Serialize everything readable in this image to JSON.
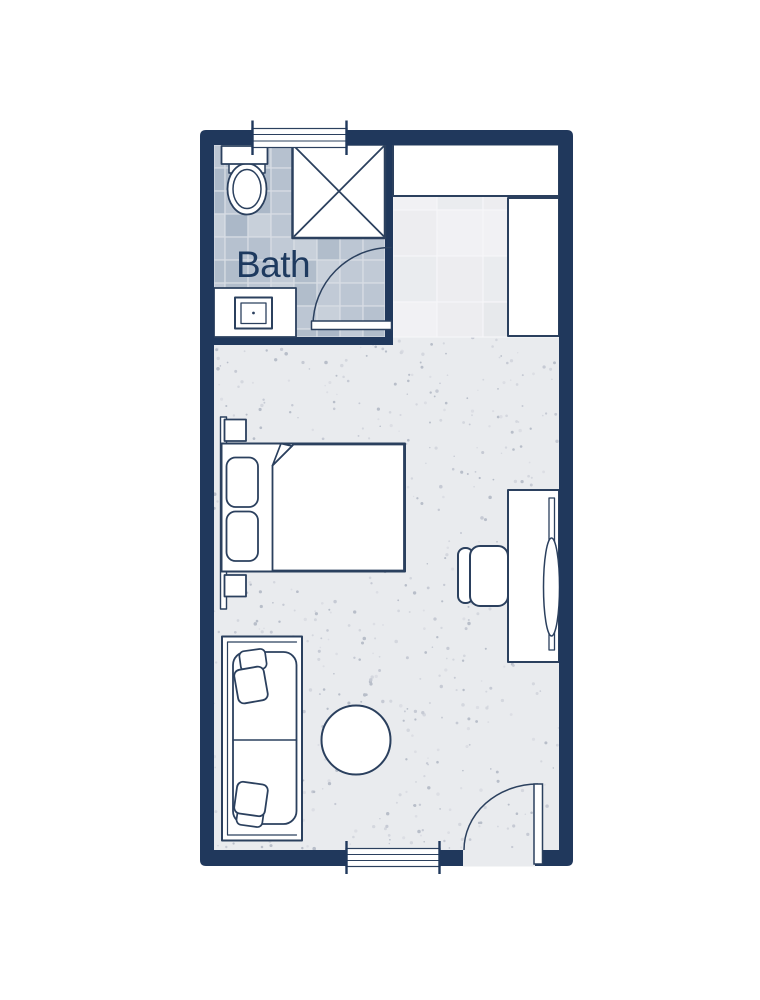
{
  "labels": {
    "bath": "Bath"
  },
  "colors": {
    "wall": "#20385c",
    "line": "#2b405e",
    "text": "#1e3a5f",
    "carpet": "#e9ebee",
    "page": "#ffffff"
  },
  "furniture_icons": [
    "bed",
    "pillow",
    "blanket",
    "nightstand",
    "headboard",
    "sofa",
    "throw-pillow",
    "round-side-table",
    "desk",
    "desk-chair",
    "mirror",
    "closet-shelf",
    "wardrobe",
    "shower",
    "toilet",
    "vanity-sink",
    "bathroom-door",
    "entry-door",
    "window"
  ],
  "decor": {
    "carpet_speckles": {
      "count": 620,
      "colors": [
        "#c6cad4",
        "#d4d7de",
        "#b8bec9",
        "#dcdee4"
      ],
      "min_r": 0.7,
      "max_r": 1.8,
      "seed": 7
    },
    "bath_tiles": {
      "size": 23,
      "origin": [
        202,
        145
      ],
      "shades": [
        "#b6c1cf",
        "#abb8c8",
        "#c1cad6",
        "#b1bdcb",
        "#bcc6d3",
        "#c8d0da"
      ],
      "grout": "#d9dee5",
      "seed": 3
    },
    "closet_tiles": {
      "size": 46,
      "origin": [
        391,
        164
      ],
      "shades": [
        "#ededf0",
        "#e7e9ec",
        "#f1f1f4",
        "#eaecef"
      ],
      "grout": "#f6f6f8",
      "seed": 5
    }
  }
}
